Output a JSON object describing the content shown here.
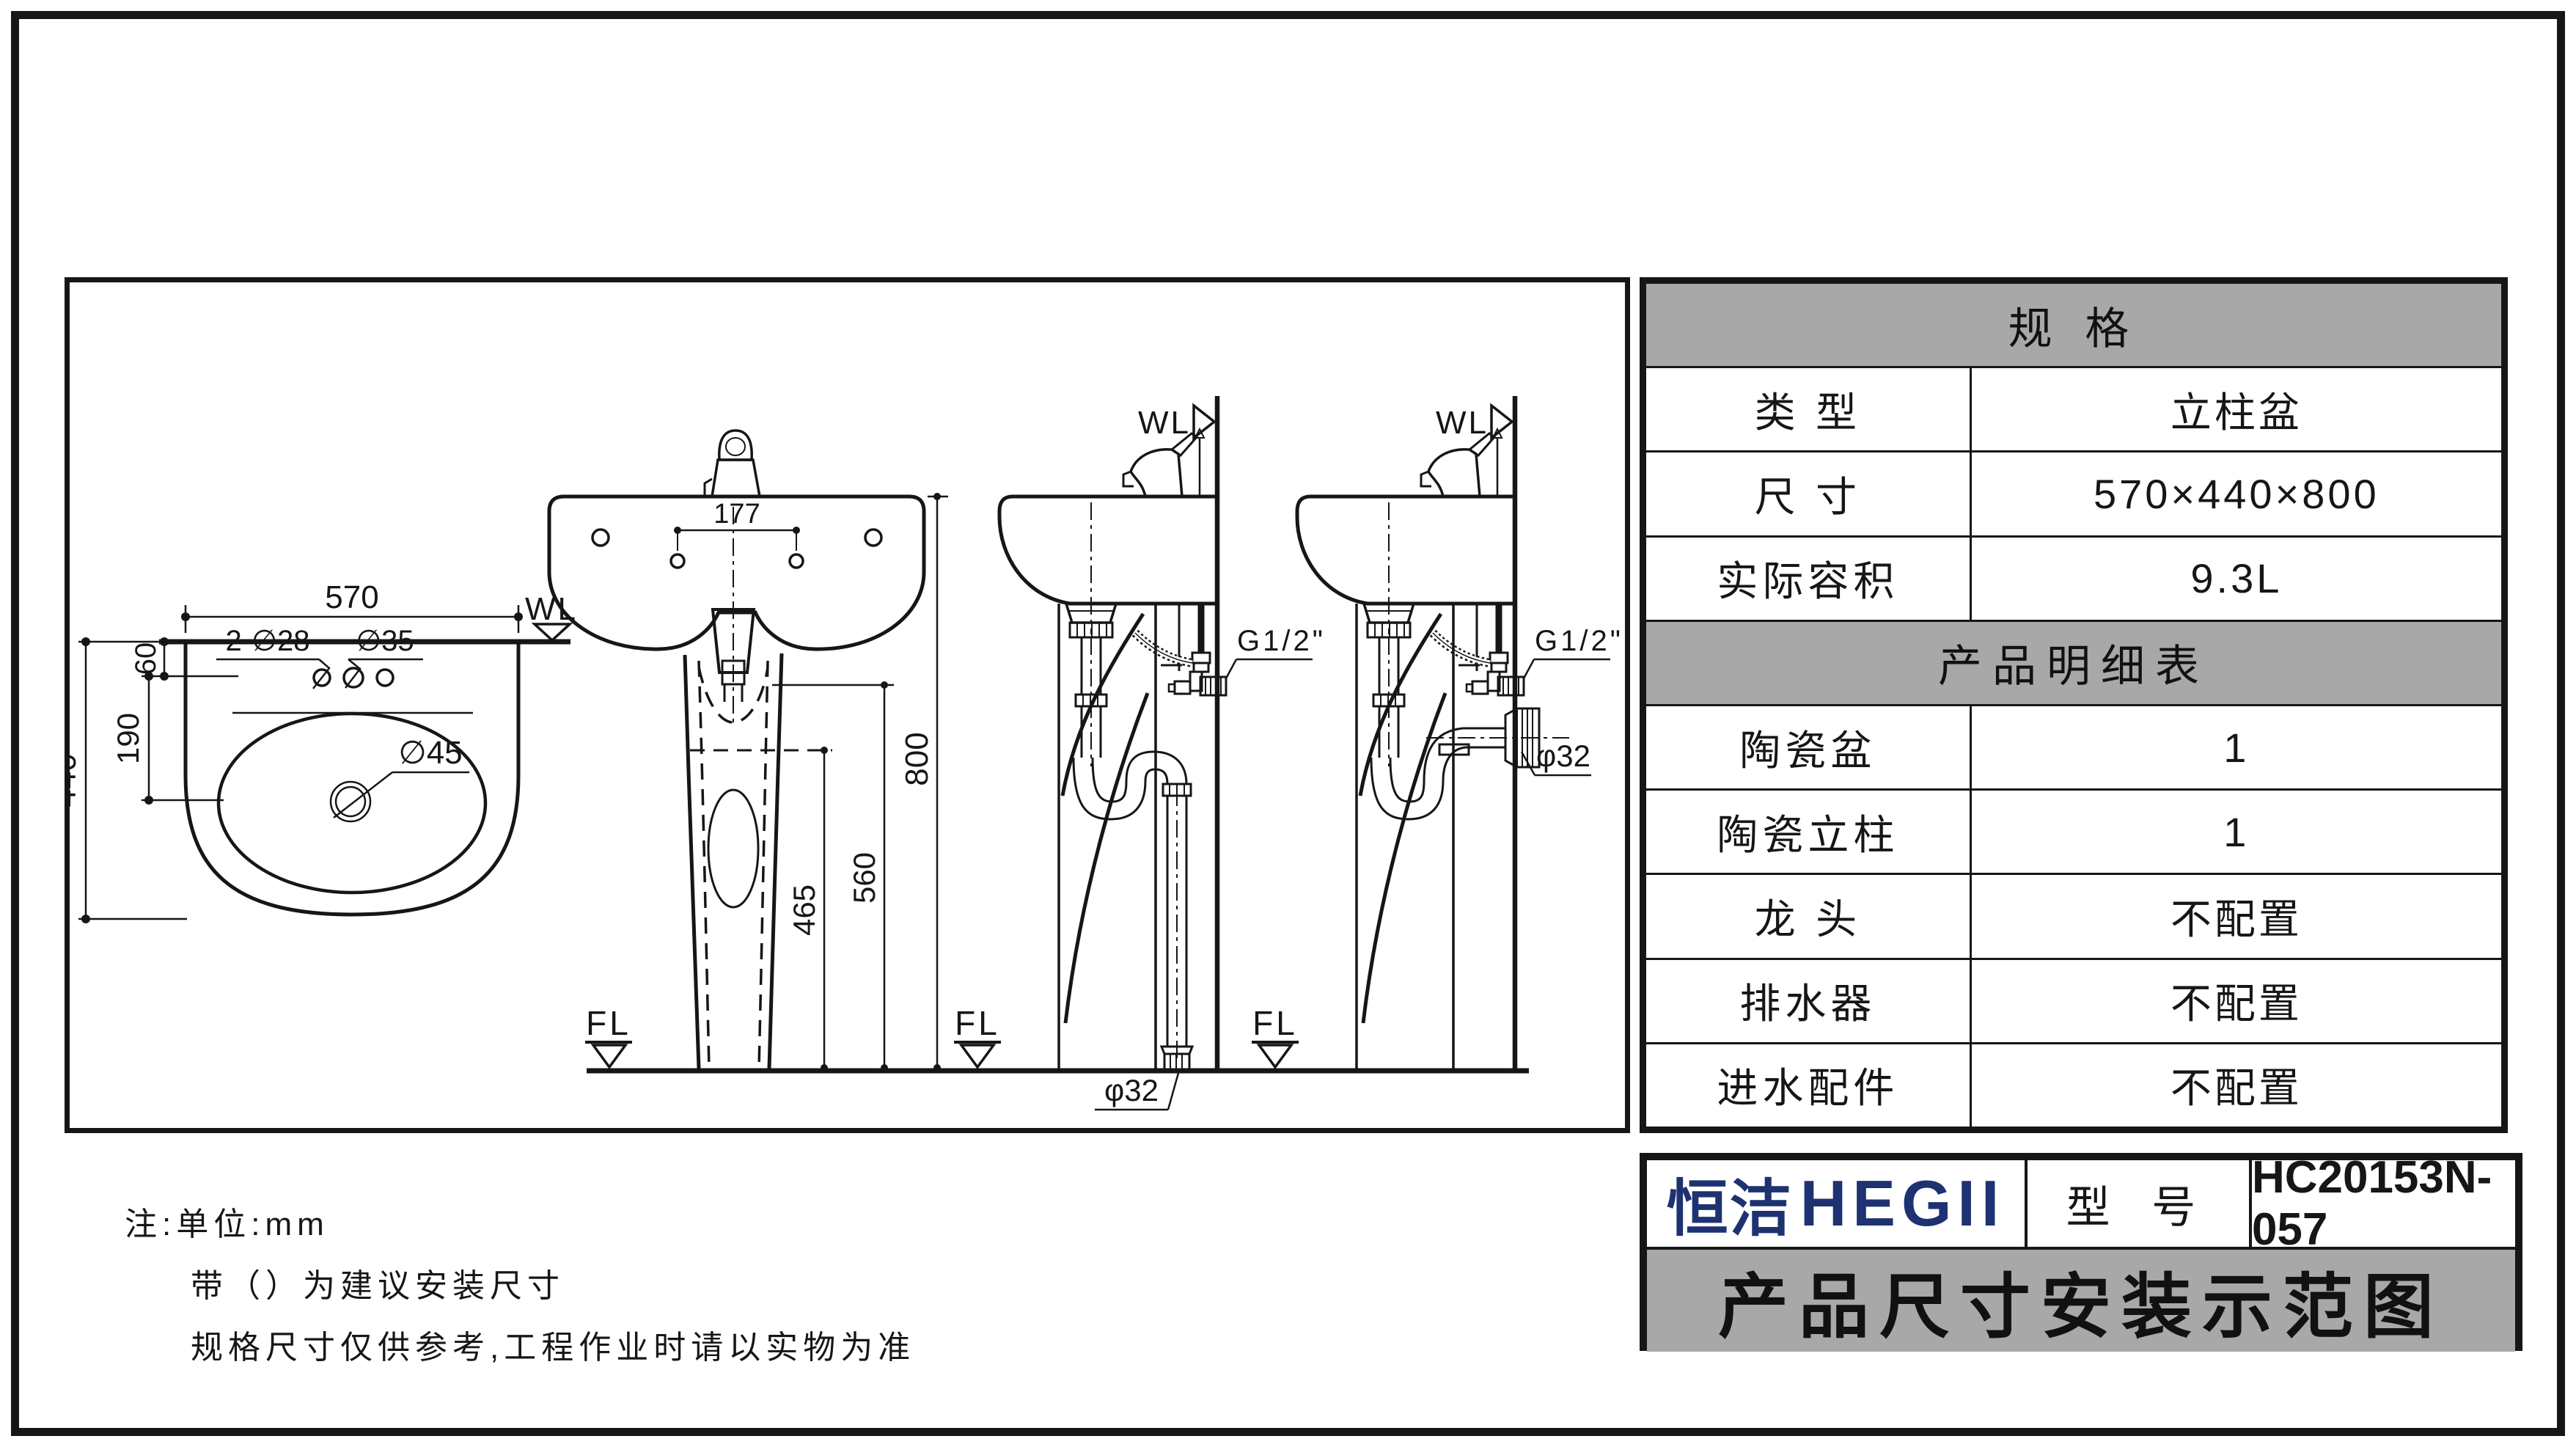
{
  "table": {
    "section1_header": "规  格",
    "rows": [
      {
        "label": "类  型",
        "value": "立柱盆"
      },
      {
        "label": "尺  寸",
        "value": "570×440×800"
      },
      {
        "label": "实际容积",
        "value": "9.3L"
      }
    ],
    "section2_header": "产品明细表",
    "rows2": [
      {
        "label": "陶瓷盆",
        "value": "1"
      },
      {
        "label": "陶瓷立柱",
        "value": "1"
      },
      {
        "label": "龙  头",
        "value": "不配置"
      },
      {
        "label": "排水器",
        "value": "不配置"
      },
      {
        "label": "进水配件",
        "value": "不配置"
      }
    ]
  },
  "title_block": {
    "brand_cn": "恒洁",
    "brand_en": "HEGII",
    "model_label": "型 号",
    "model": "HC20153N-057",
    "title": "产品尺寸安装示范图",
    "brand_color": "#1e3272",
    "header_bg": "#a8a8a8"
  },
  "notes": {
    "line1": "注:单位:mm",
    "line2": "带（）为建议安装尺寸",
    "line3": "规格尺寸仅供参考,工程作业时请以实物为准"
  },
  "drawing": {
    "top_view": {
      "dim_width": "570",
      "dim_depth": "440",
      "dim_hole_offset": "60",
      "dim_drain_offset": "190",
      "label_faucet_holes": "2-∅28",
      "label_center_hole": "∅35",
      "label_drain": "∅45",
      "wall_line": "WL"
    },
    "front_view": {
      "dim_total_height": "800",
      "dim_pedestal_height": "560",
      "dim_drain_height": "465",
      "dim_hole_spacing": "177",
      "floor_line": "FL"
    },
    "side_view": {
      "wall_line": "WL",
      "floor_line": "FL",
      "supply_thread": "G1/2\"",
      "drain_diameter": "φ32"
    }
  }
}
